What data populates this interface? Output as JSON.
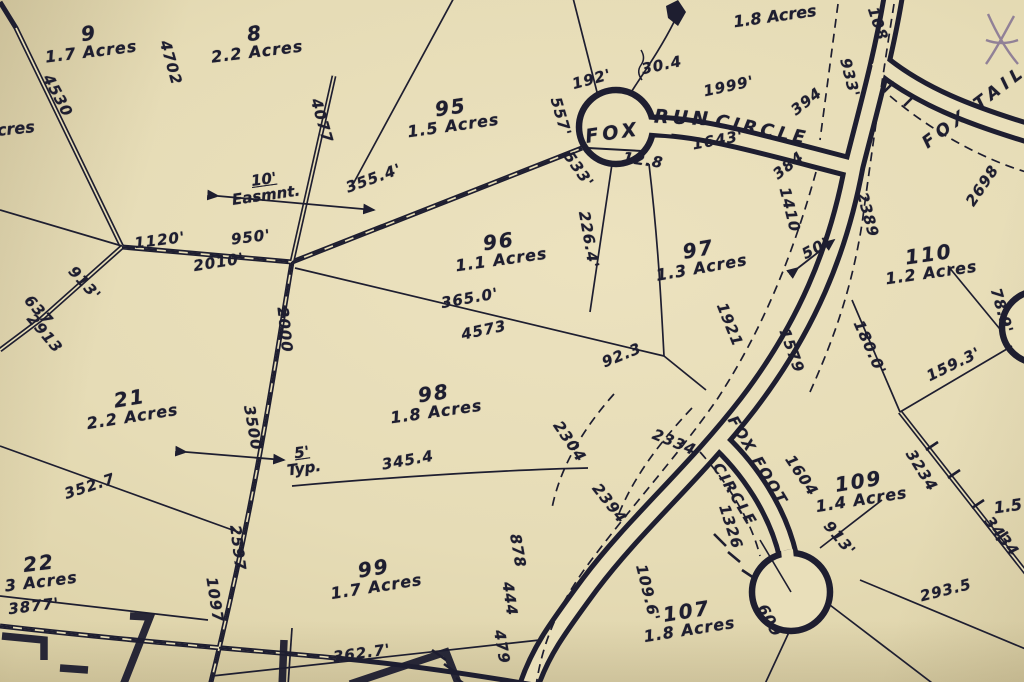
{
  "map": {
    "description_colors": {
      "paper": "#e7ddb6",
      "ink": "#1e1e30",
      "pen_mark": "#7d6b90"
    },
    "streets": [
      {
        "text": "FOX",
        "x": 613,
        "y": 134,
        "rot": -8,
        "size": 19,
        "ls": 4
      },
      {
        "text": "RUN",
        "x": 683,
        "y": 119,
        "rot": 3,
        "size": 19,
        "ls": 4
      },
      {
        "text": "CIRCLE",
        "x": 762,
        "y": 131,
        "rot": 11,
        "size": 18,
        "ls": 4
      },
      {
        "text": "FOX TAIL",
        "x": 975,
        "y": 108,
        "rot": -37,
        "size": 17,
        "ls": 5
      },
      {
        "text": "FOX FOOT",
        "x": 757,
        "y": 461,
        "rot": 59,
        "size": 15,
        "ls": 2
      },
      {
        "text": "CIRCLE",
        "x": 734,
        "y": 495,
        "rot": 59,
        "size": 15,
        "ls": 2
      }
    ],
    "lots": [
      {
        "number": "9",
        "acres": "1.7 Acres",
        "x": 90,
        "y": 42,
        "rot": -7
      },
      {
        "number": "8",
        "acres": "2.2 Acres",
        "x": 256,
        "y": 42,
        "rot": -7
      },
      {
        "number": "95",
        "acres": "1.5 Acres",
        "x": 452,
        "y": 116,
        "rot": -8
      },
      {
        "number": "96",
        "acres": "1.1 Acres",
        "x": 500,
        "y": 250,
        "rot": -8
      },
      {
        "number": "97",
        "acres": "1.3 Acres",
        "x": 700,
        "y": 258,
        "rot": -10
      },
      {
        "number": "98",
        "acres": "1.8 Acres",
        "x": 435,
        "y": 402,
        "rot": -8
      },
      {
        "number": "99",
        "acres": "1.7 Acres",
        "x": 375,
        "y": 577,
        "rot": -9
      },
      {
        "number": "21",
        "acres": "2.2 Acres",
        "x": 131,
        "y": 407,
        "rot": -9
      },
      {
        "number": "22",
        "acres": "3 Acres",
        "x": 40,
        "y": 572,
        "rot": -7
      },
      {
        "number": "107",
        "acres": "1.8 Acres",
        "x": 688,
        "y": 620,
        "rot": -9
      },
      {
        "number": "109",
        "acres": "1.4 Acres",
        "x": 860,
        "y": 490,
        "rot": -9
      },
      {
        "number": "110",
        "acres": "1.2 Acres",
        "x": 930,
        "y": 263,
        "rot": -8
      }
    ],
    "partial_labels": [
      {
        "text": "Acres",
        "x": 10,
        "y": 130,
        "rot": -6
      },
      {
        "text": "1.8 Acres",
        "x": 775,
        "y": 17,
        "rot": -8
      },
      {
        "text": "1.5",
        "x": 1008,
        "y": 507,
        "rot": -8
      }
    ],
    "dimensions": [
      {
        "text": "4530",
        "x": 57,
        "y": 96,
        "rot": 62
      },
      {
        "text": "4702",
        "x": 170,
        "y": 63,
        "rot": 74
      },
      {
        "text": "4077",
        "x": 321,
        "y": 121,
        "rot": 74
      },
      {
        "text": "355.4'",
        "x": 374,
        "y": 179,
        "rot": -20
      },
      {
        "text": "1120'",
        "x": 160,
        "y": 241,
        "rot": -7
      },
      {
        "text": "950'",
        "x": 251,
        "y": 238,
        "rot": -7
      },
      {
        "text": "2010'",
        "x": 219,
        "y": 263,
        "rot": -9
      },
      {
        "text": "913'",
        "x": 84,
        "y": 284,
        "rot": 48
      },
      {
        "text": "637",
        "x": 38,
        "y": 311,
        "rot": 48
      },
      {
        "text": "2913",
        "x": 44,
        "y": 334,
        "rot": 50
      },
      {
        "text": "2000",
        "x": 284,
        "y": 330,
        "rot": 84
      },
      {
        "text": "3500",
        "x": 252,
        "y": 428,
        "rot": 80
      },
      {
        "text": "2597",
        "x": 237,
        "y": 548,
        "rot": 83
      },
      {
        "text": "1097",
        "x": 214,
        "y": 600,
        "rot": 81
      },
      {
        "text": "3877'",
        "x": 34,
        "y": 607,
        "rot": -7
      },
      {
        "text": "352.7",
        "x": 90,
        "y": 487,
        "rot": -18
      },
      {
        "text": "345.4",
        "x": 408,
        "y": 461,
        "rot": -10
      },
      {
        "text": "362.7'",
        "x": 362,
        "y": 654,
        "rot": -8
      },
      {
        "text": "365.0'",
        "x": 470,
        "y": 299,
        "rot": -10
      },
      {
        "text": "4573",
        "x": 484,
        "y": 331,
        "rot": -12
      },
      {
        "text": "92.3",
        "x": 622,
        "y": 356,
        "rot": -22
      },
      {
        "text": "226.4'",
        "x": 588,
        "y": 240,
        "rot": 80
      },
      {
        "text": "557'",
        "x": 560,
        "y": 117,
        "rot": 74
      },
      {
        "text": "533'",
        "x": 578,
        "y": 170,
        "rot": 55
      },
      {
        "text": "192'",
        "x": 592,
        "y": 80,
        "rot": -15
      },
      {
        "text": "30.4",
        "x": 662,
        "y": 66,
        "rot": -12
      },
      {
        "text": "1999'",
        "x": 729,
        "y": 87,
        "rot": -12
      },
      {
        "text": "394",
        "x": 807,
        "y": 102,
        "rot": -38
      },
      {
        "text": "933'",
        "x": 849,
        "y": 78,
        "rot": 76
      },
      {
        "text": "108",
        "x": 877,
        "y": 24,
        "rot": 72
      },
      {
        "text": "1643'",
        "x": 718,
        "y": 141,
        "rot": -10
      },
      {
        "text": "12.8",
        "x": 643,
        "y": 161,
        "rot": 8
      },
      {
        "text": "384",
        "x": 789,
        "y": 166,
        "rot": -38
      },
      {
        "text": "1410",
        "x": 789,
        "y": 210,
        "rot": 76
      },
      {
        "text": "50'",
        "x": 816,
        "y": 249,
        "rot": -28
      },
      {
        "text": "2389",
        "x": 867,
        "y": 215,
        "rot": 75
      },
      {
        "text": "2698",
        "x": 983,
        "y": 186,
        "rot": -56
      },
      {
        "text": "1921",
        "x": 729,
        "y": 325,
        "rot": 68
      },
      {
        "text": "1579",
        "x": 791,
        "y": 351,
        "rot": 70
      },
      {
        "text": "180.0'",
        "x": 869,
        "y": 348,
        "rot": 66
      },
      {
        "text": "159.3'",
        "x": 954,
        "y": 365,
        "rot": -26
      },
      {
        "text": "78.9'",
        "x": 1001,
        "y": 311,
        "rot": 74
      },
      {
        "text": "2304",
        "x": 569,
        "y": 442,
        "rot": 56
      },
      {
        "text": "2334",
        "x": 674,
        "y": 443,
        "rot": 22
      },
      {
        "text": "2394",
        "x": 609,
        "y": 504,
        "rot": 52
      },
      {
        "text": "1604",
        "x": 801,
        "y": 476,
        "rot": 56
      },
      {
        "text": "1326",
        "x": 730,
        "y": 527,
        "rot": 72
      },
      {
        "text": "913'",
        "x": 839,
        "y": 539,
        "rot": 50
      },
      {
        "text": "109.6'",
        "x": 647,
        "y": 593,
        "rot": 76
      },
      {
        "text": "609",
        "x": 769,
        "y": 621,
        "rot": 62
      },
      {
        "text": "293.5",
        "x": 946,
        "y": 591,
        "rot": -14
      },
      {
        "text": "3234",
        "x": 921,
        "y": 471,
        "rot": 58
      },
      {
        "text": "3434",
        "x": 1001,
        "y": 537,
        "rot": 52
      },
      {
        "text": "878",
        "x": 517,
        "y": 551,
        "rot": 80
      },
      {
        "text": "444",
        "x": 509,
        "y": 599,
        "rot": 82
      },
      {
        "text": "479",
        "x": 501,
        "y": 647,
        "rot": 80
      }
    ],
    "annotations": [
      {
        "line1": "10'",
        "line2": "Easmnt.",
        "x": 265,
        "y": 188,
        "rot": -8
      },
      {
        "line1": "5'",
        "line2": "Typ.",
        "x": 303,
        "y": 461,
        "rot": -8
      }
    ]
  }
}
